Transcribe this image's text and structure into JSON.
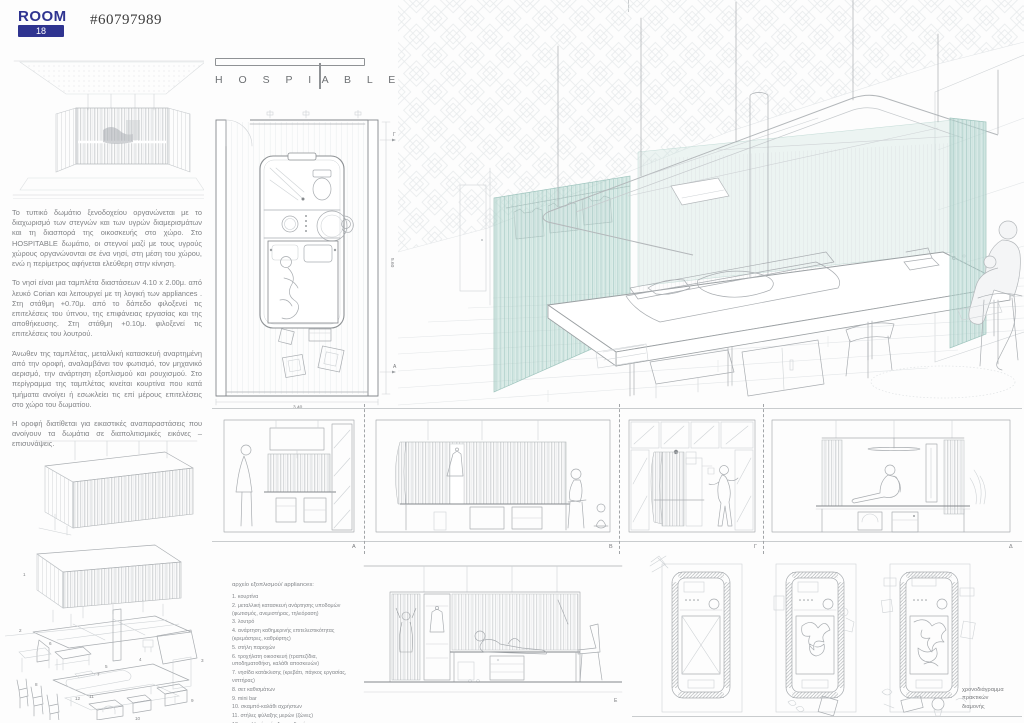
{
  "header": {
    "logo_word": "ROOM",
    "logo_number": "18",
    "entry_number": "#60797989",
    "accent_blue": "#2f3490"
  },
  "title": {
    "left_letters": "H O S P I",
    "right_letters": "A B L E",
    "name": "HOSPITABLE"
  },
  "description": {
    "p1": "Το τυπικό δωμάτιο ξενοδοχείου οργανώνεται με το διαχωρισμό των στεγνών και των υγρών διαμερισμάτων και τη διασπορά της οικοσκευής στο χώρο. Στο HOSPITABLE δωμάτιο, οι στεγνοί μαζί με τους υγρούς χώρους οργανώνονται σε ένα νησί, στη μέση του χώρου, ενώ η περίμετρος αφήνεται ελεύθερη στην κίνηση.",
    "p2": "Το νησί είναι μια ταμπλέτα διαστάσεων 4.10 x 2.00μ. από λευκό Corian και λειτουργεί με τη λογική των appliances . Στη στάθμη +0.70μ. από το δάπεδο φιλοξενεί τις επιτελέσεις του ύπνου, της επιφάνειας εργασίας και της αποθήκευσης. Στη στάθμη +0.10μ. φιλοξενεί τις επιτελέσεις του λουτρού.",
    "p3": "Άνωθεν της ταμπλέτας, μεταλλική κατασκευή αναρτημένη από την οροφή, αναλαμβάνει τον φωτισμό, τον μηχανικό αερισμό, την ανάρτηση εξοπλισμού και ρουχισμού. Στο περίγραμμα της ταμπλέτας κινείται κουρτίνα που κατά τμήματα ανοίγει ή εσωκλείει τις επί μέρους επιτελέσεις στο χώρο του δωματίου.",
    "p4": "Η οροφή διατίθεται για εικαστικές αναπαραστάσεις που ανοίγουν τα δωμάτια σε διαπολιτισμικές εικόνες – επισυνάψεις."
  },
  "plan": {
    "dim_bottom": "3.40",
    "dim_right": "5.60",
    "marker_top": "Γ",
    "marker_bottom": "A"
  },
  "sections": {
    "labels": [
      "A",
      "B",
      "Γ",
      "Δ"
    ],
    "label_e": "E"
  },
  "exploded": {
    "numbers": [
      "1",
      "2",
      "3",
      "4",
      "5",
      "6",
      "7",
      "8",
      "9",
      "10",
      "11",
      "12"
    ]
  },
  "legend": {
    "title": "αρχείο εξοπλισμού/ appliances:",
    "items": [
      "1. κουρτίνα",
      "2. μεταλλική κατασκευή ανάρτησης υποδομών (φωτισμός, ανεμιστήρας, τηλεόραση)",
      "3. λουτρό",
      "4. ανάρτηση καθημερινής επιτελεστικότητας (κρεμάστρες, καθρέφτης)",
      "5. στήλη παροχών",
      "6. τροχήλατη οικοσκευή (τραπεζίδια, υποδηματοθήκη, καλάθι αποσκευών)",
      "7. νησίδα κατάκλισης (κρεβάτι, πάγκος εργασίας, νιπτήρας)",
      "8. σετ καθισμάτων",
      "9. mini bar",
      "10. σκαμπό-καλάθι αχρήστων",
      "11. στήλες φύλαξης μερών (ζώνες)",
      "12. μεταλλική στήριξη υποδομής"
    ]
  },
  "timeline": {
    "caption_line1": "χρονοδιάγραμμα",
    "caption_line2": "πρακτικών",
    "caption_line3": "διαμονής"
  },
  "colors": {
    "curtain_teal": "#9ec4bd",
    "line_gray": "#a9adb1",
    "text_gray": "#808285"
  }
}
